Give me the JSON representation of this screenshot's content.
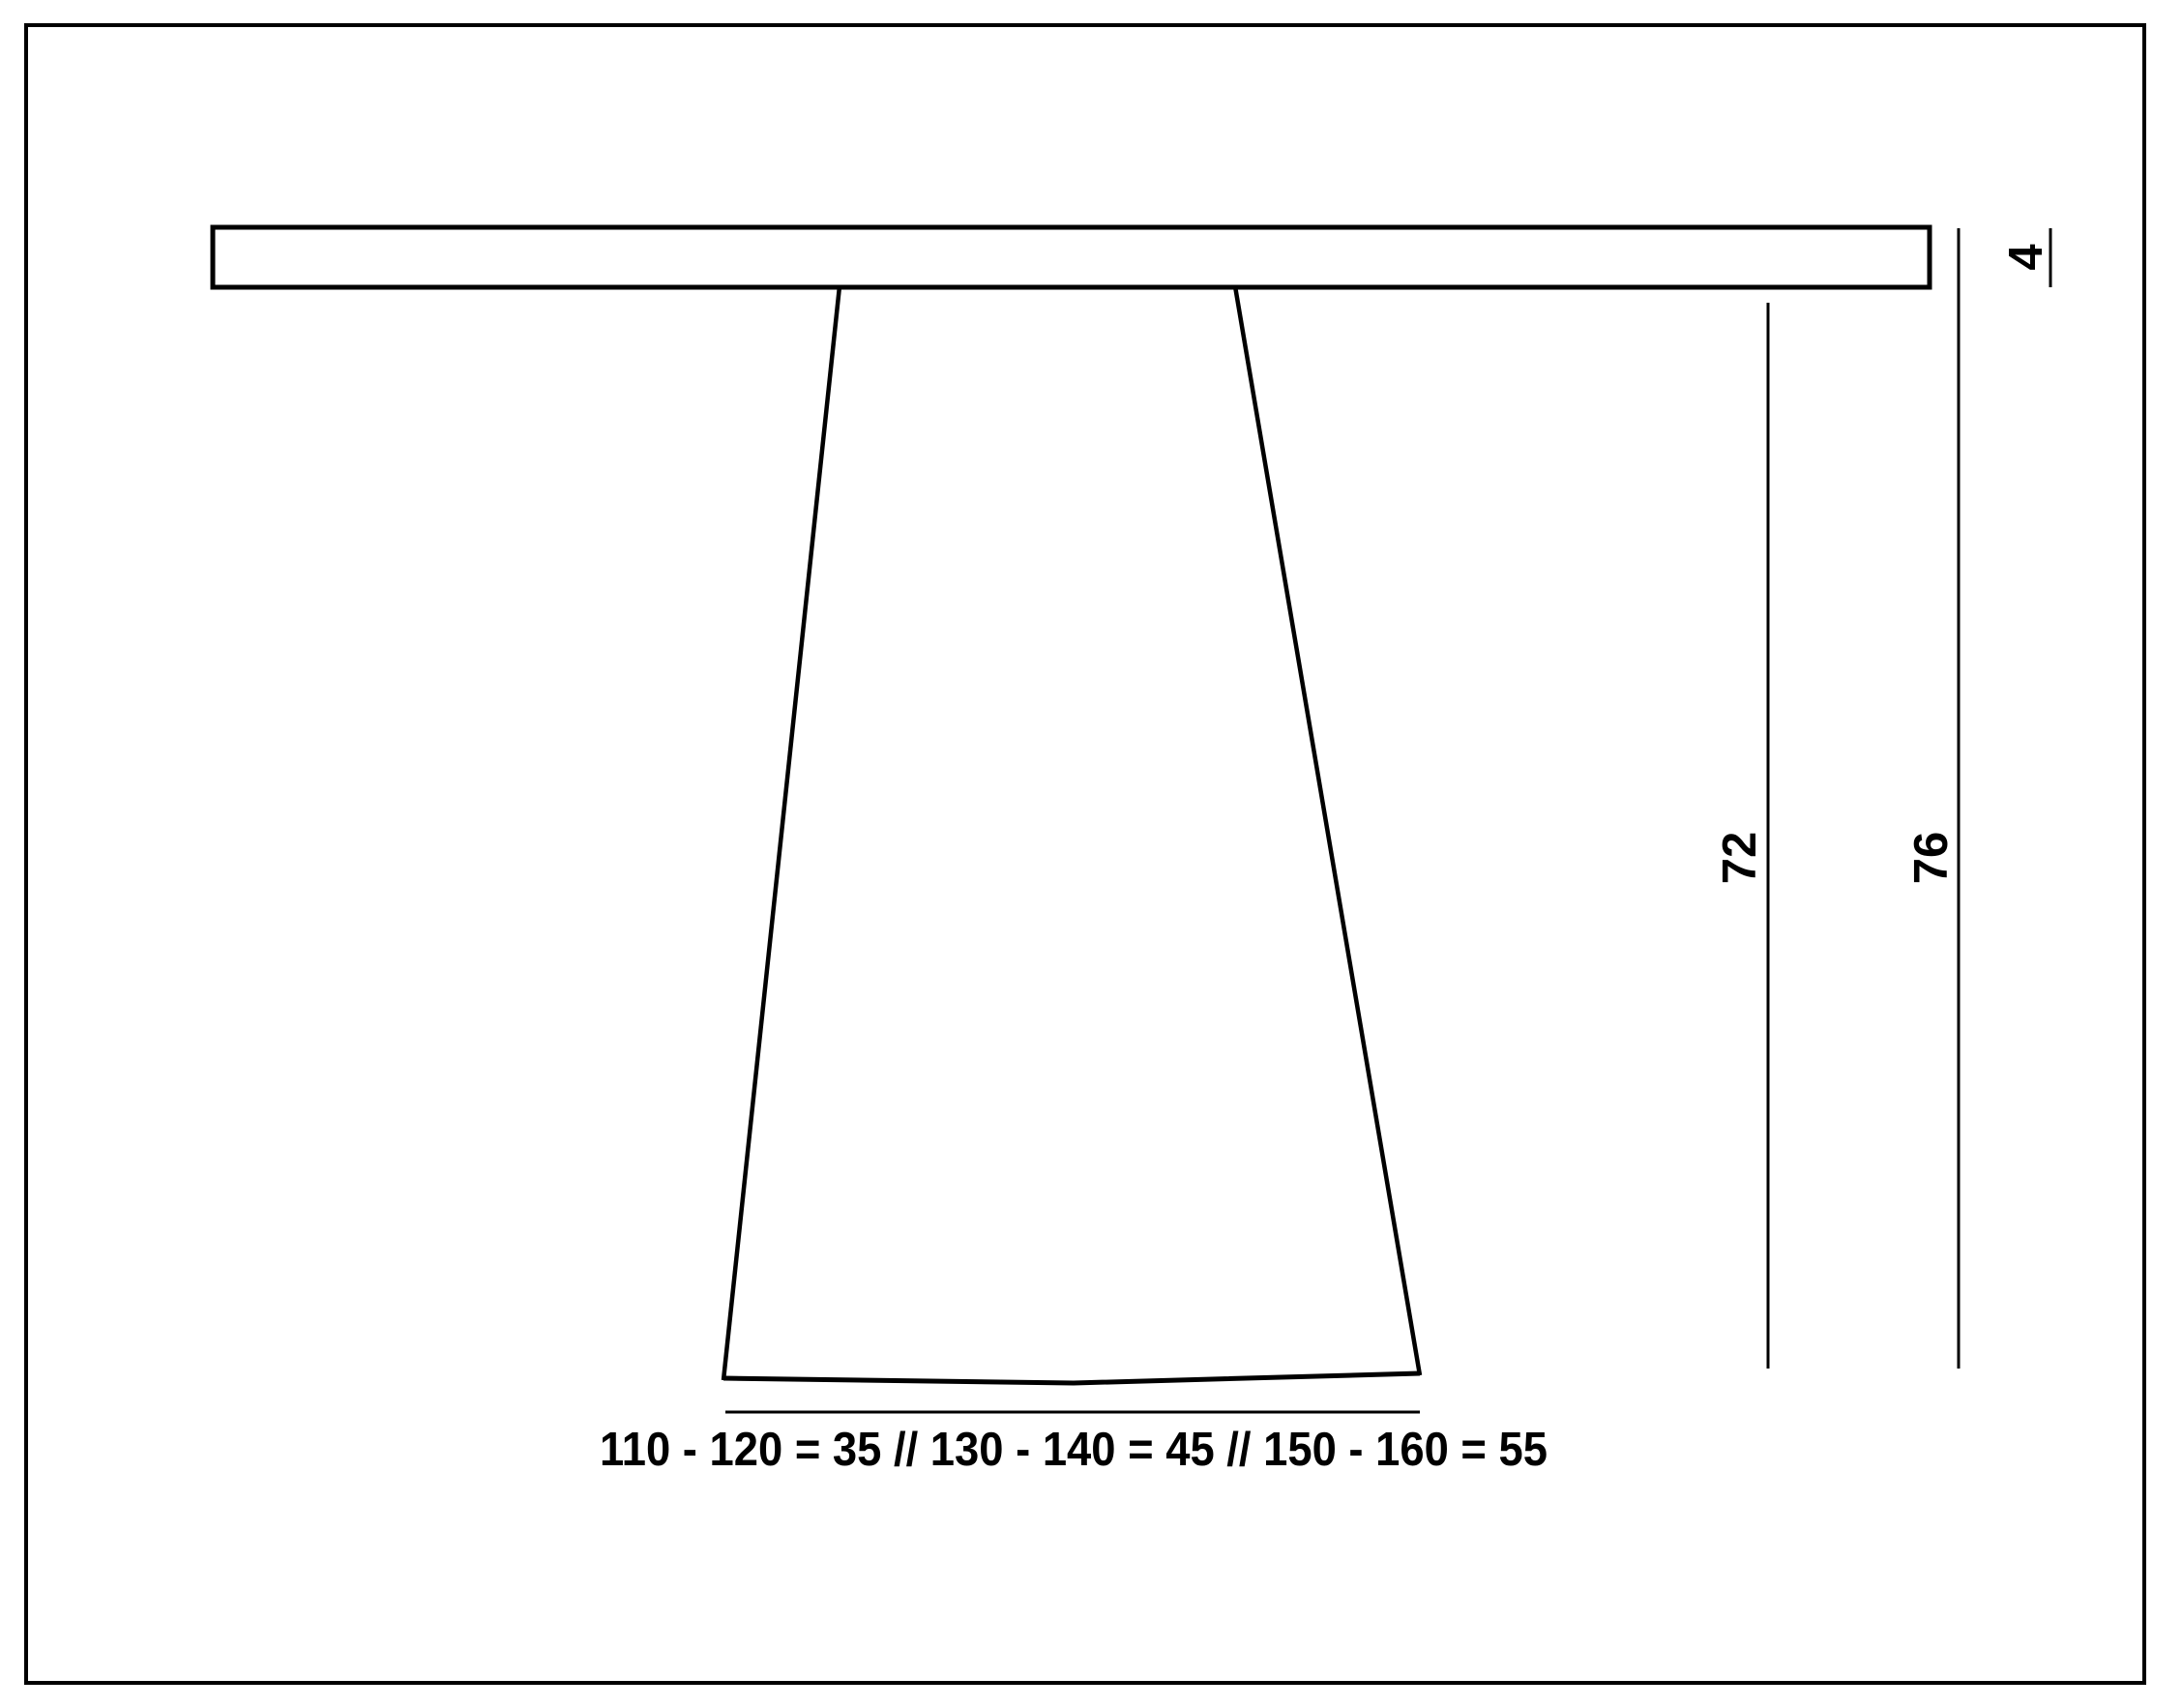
{
  "page": {
    "background": "#ffffff",
    "stroke_color": "#000000"
  },
  "drawing": {
    "type": "furniture-dimension-drawing",
    "subject": "pedestal-table-side-view",
    "labels": {
      "thickness": "4",
      "pedestal_height": "72",
      "total_height": "76",
      "base_widths": "110 - 120 = 35 // 130 - 140 = 45 // 150 - 160 = 55"
    }
  }
}
